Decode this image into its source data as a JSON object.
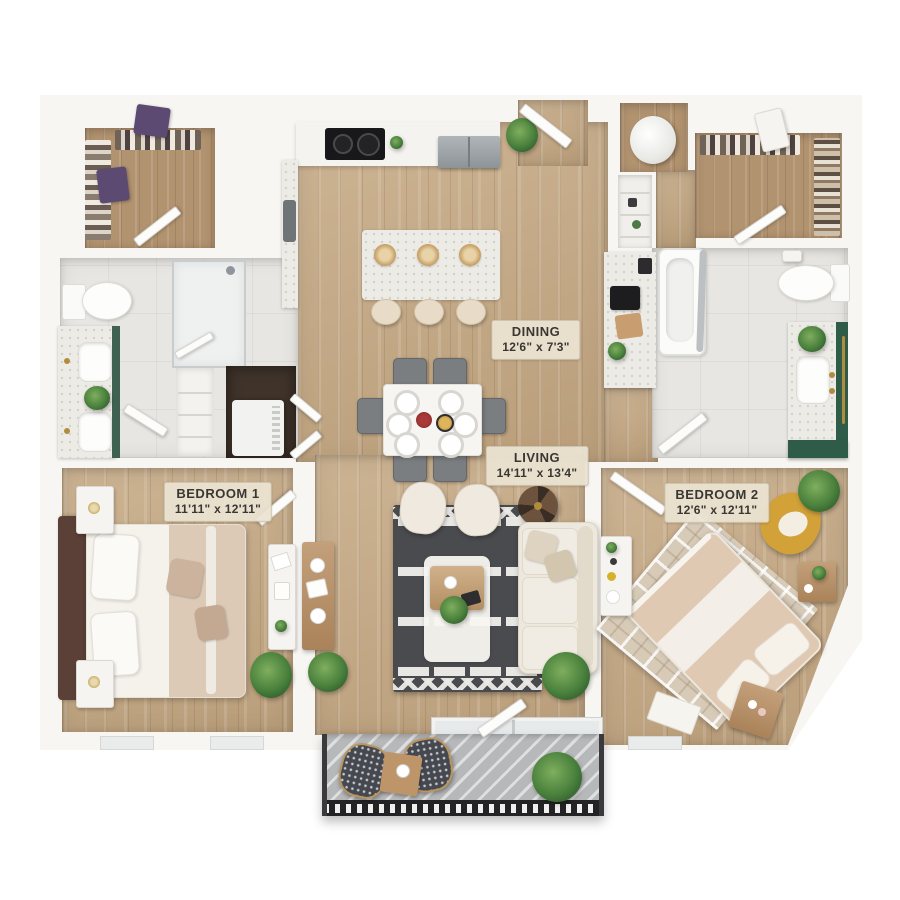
{
  "floorplan": {
    "type": "apartment-two-bed-two-bath-floor-plan",
    "rooms": {
      "dining": {
        "name": "DINING",
        "dims": "12'6\" x 7'3\""
      },
      "living": {
        "name": "LIVING",
        "dims": "14'11\" x 13'4\""
      },
      "bedroom1": {
        "name": "BEDROOM 1",
        "dims": "11'11\" x 12'11\""
      },
      "bedroom2": {
        "name": "BEDROOM 2",
        "dims": "12'6\" x 12'11\""
      }
    },
    "colors": {
      "wall": "#f7f6f3",
      "wood_floor": "#c5a984",
      "closet_floor": "#b29370",
      "tile_floor": "#e7e6e2",
      "living_rug": "#4a4b4e",
      "bedroom2_rug": "#d7cbb8",
      "sofa": "#ede8de",
      "yellow_chair": "#d2a138",
      "vanity_green": "#2f5b49",
      "balcony_floor": "#b7b8ba",
      "railing": "#232326",
      "label_bg": "#ebe3d2"
    }
  }
}
